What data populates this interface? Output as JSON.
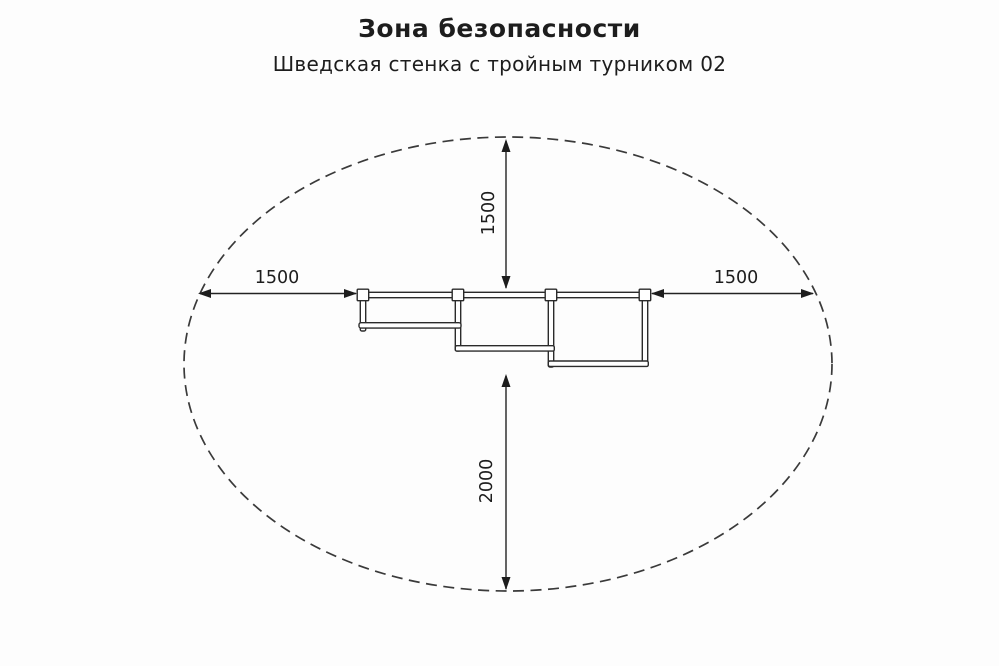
{
  "header": {
    "title": "Зона безопасности",
    "subtitle": "Шведская стенка с тройным турником 02"
  },
  "dimensions": {
    "top_clearance": "1500",
    "left_clearance": "1500",
    "right_clearance": "1500",
    "bottom_clearance": "2000"
  },
  "colors": {
    "line": "#2b2b2b",
    "boundary_dash": "#3a3a3a",
    "background": "#fdfdfd",
    "text": "#1d1d1d"
  }
}
